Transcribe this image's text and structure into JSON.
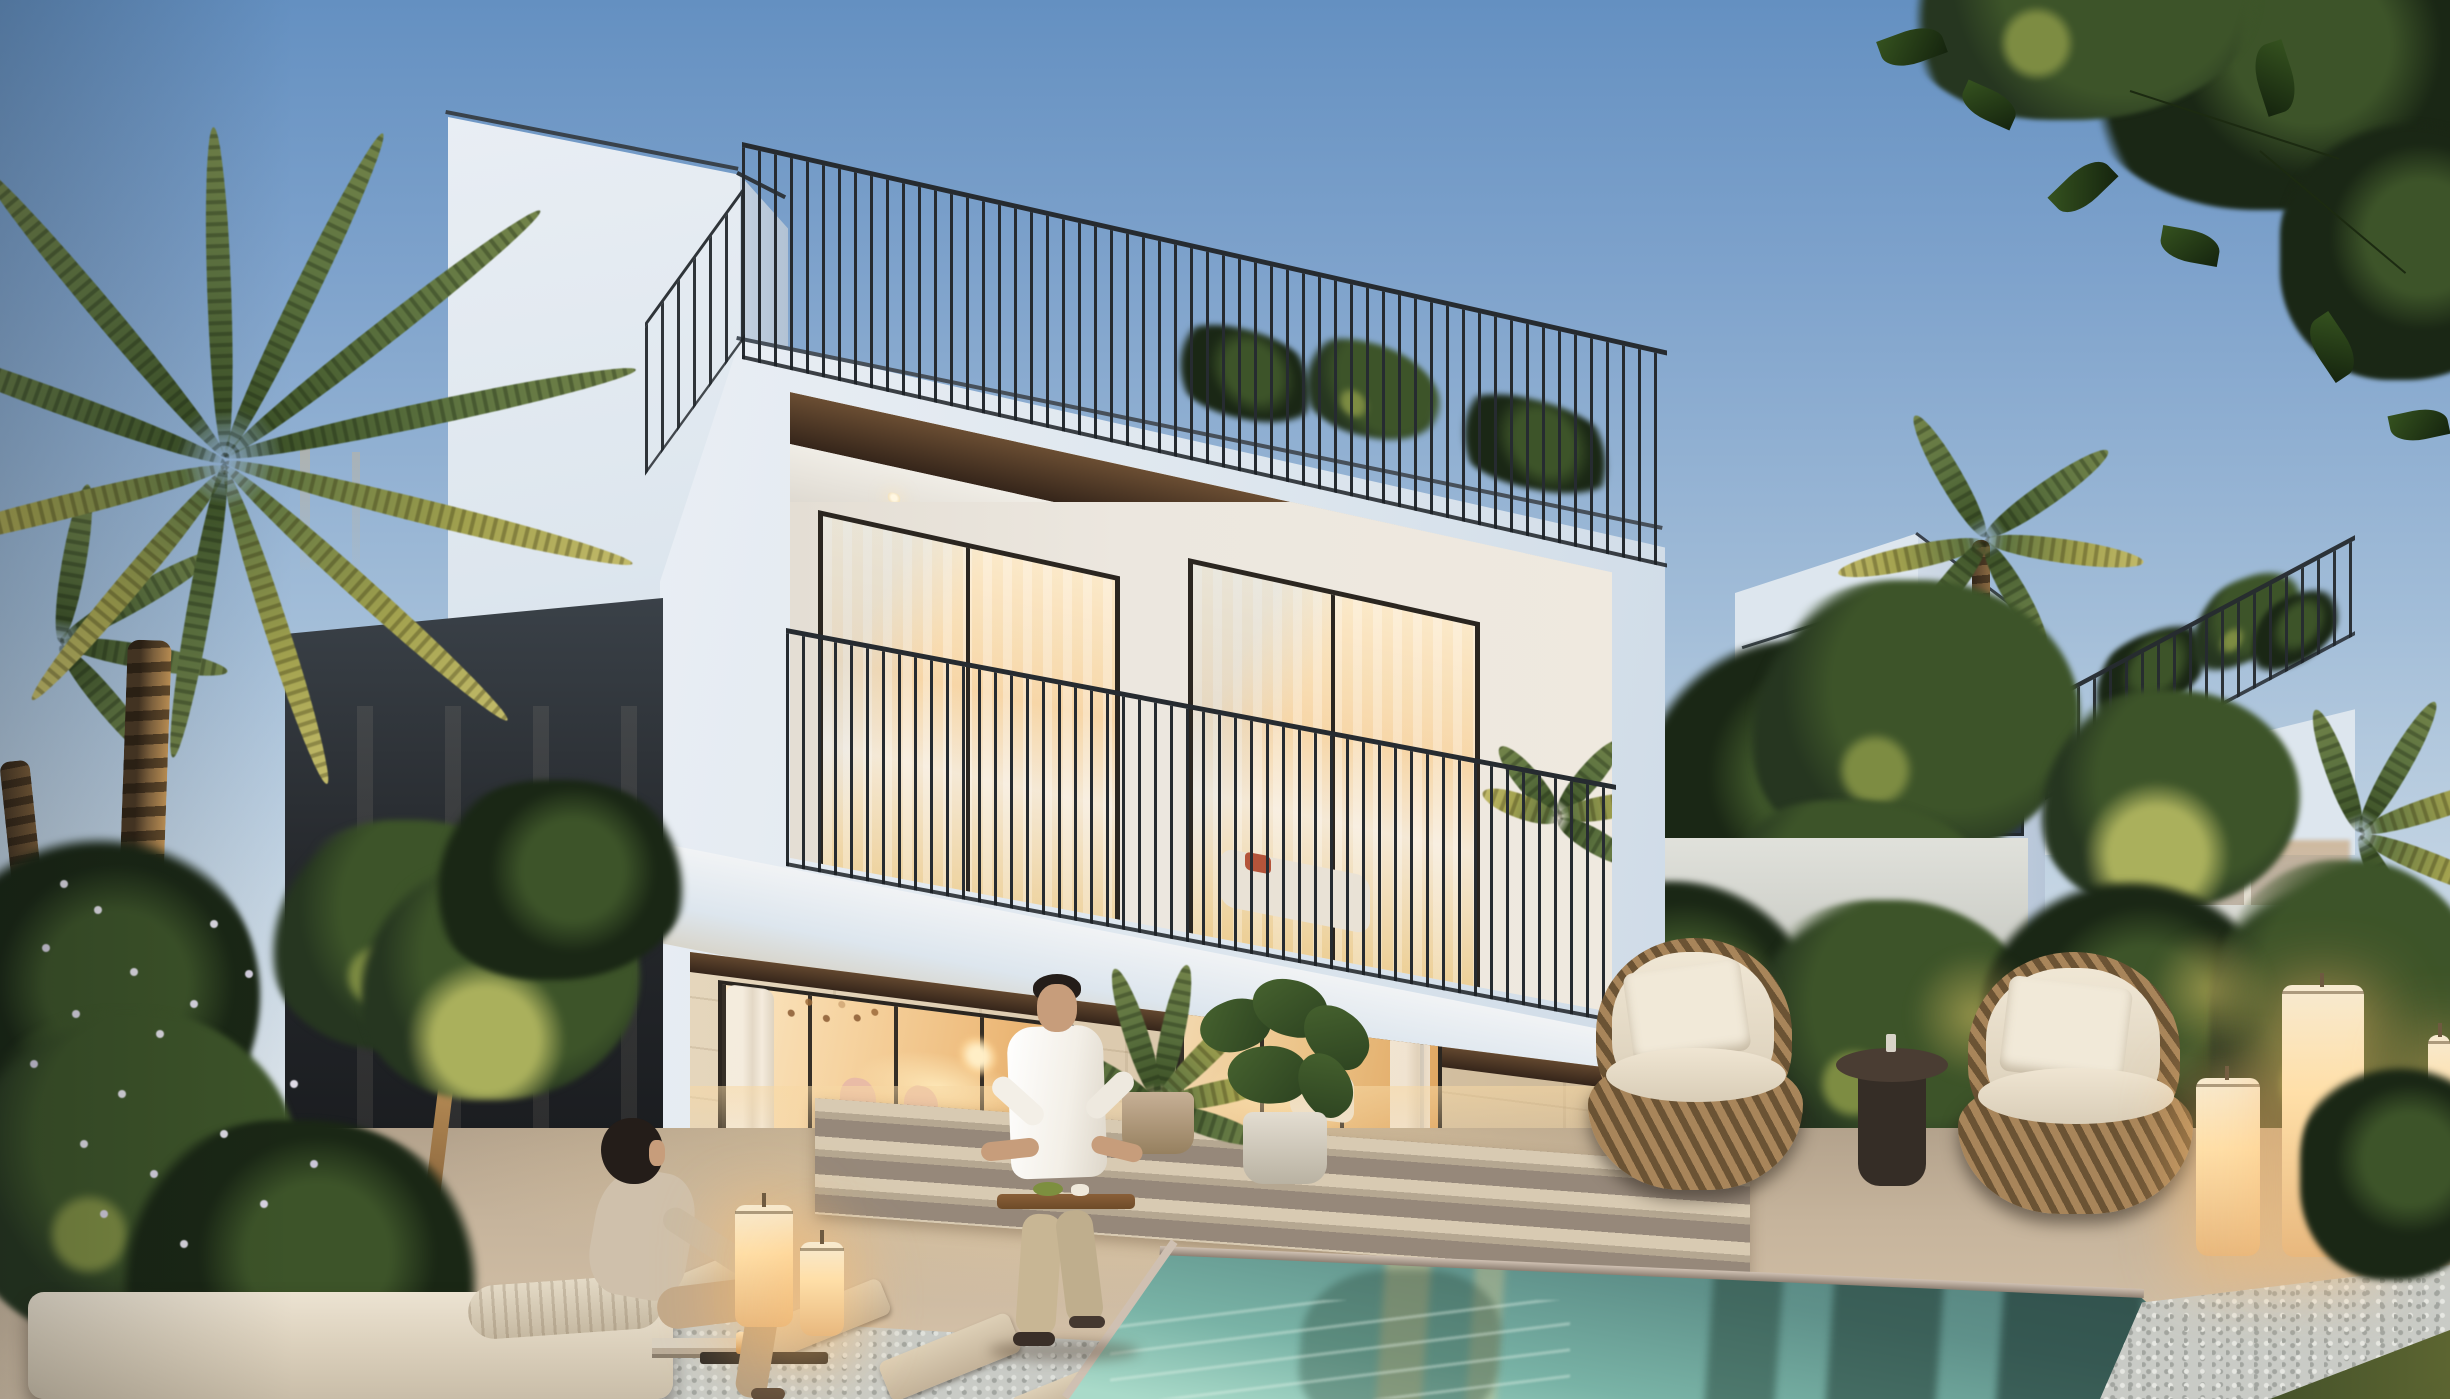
{
  "scene": {
    "type": "architectural-exterior-render",
    "time_of_day": "dusk",
    "subject": "modern three-storey white villa with roof terrace, lit interiors, garden and swimming pool",
    "people": [
      {
        "label": "woman-seated-on-daybed",
        "position": "left-foreground"
      },
      {
        "label": "man-carrying-tray",
        "position": "center-foreground-walking-by-pool"
      }
    ],
    "objects": [
      "rooftop-railing",
      "balcony",
      "sliding-glass-doors",
      "palm-trees",
      "flowering-bush",
      "pool",
      "wicker-lounge-chairs",
      "side-table",
      "glowing-lanterns",
      "stepping-stones",
      "background-villa",
      "overhanging-branch"
    ]
  },
  "palette": {
    "sky_top": "#6490c1",
    "sky_upper": "#7fa3cc",
    "sky_mid": "#a2bdd8",
    "sky_low": "#c3d4e3",
    "sky_horizon": "#dae3ea",
    "white_lit": "#e9eef4",
    "white_mid": "#dde6ee",
    "tower_edge": "#39424b",
    "railing_dark": "#262b30",
    "wood_soffit_1": "#6b4e33",
    "wood_soffit_2": "#35251a",
    "ceiling_white": "#f0ede6",
    "interior_wall": "#ece7df",
    "glass_warm_1": "#fbe7c4",
    "glass_warm_2": "#f6d3a0",
    "glass_warm_3": "#e9c277",
    "glass_warm_4": "#eebc7d",
    "glass_deep": "#dfa45e",
    "frame_dark": "#2b2620",
    "stone_1": "#e5d6bc",
    "stone_2": "#dccaae",
    "stone_3": "#cdb897",
    "annex_1": "#26292d",
    "annex_2": "#181a1d",
    "paving_1": "#b3a28c",
    "paving_2": "#c6b49c",
    "paving_3": "#d2bfa6",
    "step_light": "#d8cab2",
    "step_mid": "#b5a791",
    "step_dark": "#96887a",
    "pool_1": "#79b3a6",
    "pool_2": "#5f918a",
    "pool_3": "#4f7a77",
    "pool_4": "#44656a",
    "pool_light": "#a9dac9",
    "coping": "#cfc0b2",
    "pebble": "#c9cbc6",
    "pebble_dark": "#a2a5a0",
    "grass_1": "#45522a",
    "grass_2": "#5c6531",
    "grass_dark": "#2c371f",
    "fol_dark": "#263620",
    "fol_mid": "#3d5429",
    "fol_deep": "#1a2715",
    "fol_warm": "#7d8c42",
    "fol_lit": "#aab05c",
    "palm_1": "#3f5429",
    "palm_2": "#5d7340",
    "palm_3": "#73844a",
    "palm_warm": "#a3a24f",
    "trunk_1": "#8a6a42",
    "trunk_2": "#4a3824",
    "branch_warm": "#c89a5e",
    "flower_white": "#e9e5f0",
    "lantern_1": "#ffdfa8",
    "lantern_2": "#e8b87e",
    "lantern_glow": "rgba(255,190,110,0.45)",
    "wicker_1": "#a8855a",
    "wicker_2": "#6b5334",
    "cushion_1": "#ddd2be",
    "cushion_2": "#d9cdb7",
    "table_dark": "#4a3d33",
    "skin": "#c79d7b",
    "hair": "#241d19",
    "shirt": "#f3efe7",
    "pants_man": "#c8b694",
    "top_woman": "#cfc0ab",
    "pants_woman": "#c3a98a",
    "tray_wood": "#8a5f38",
    "window_dark_1": "#49586b",
    "window_dark_2": "#2e3a49",
    "bgv_front": "#dde6ee",
    "bgv_side": "#cfdae6"
  }
}
